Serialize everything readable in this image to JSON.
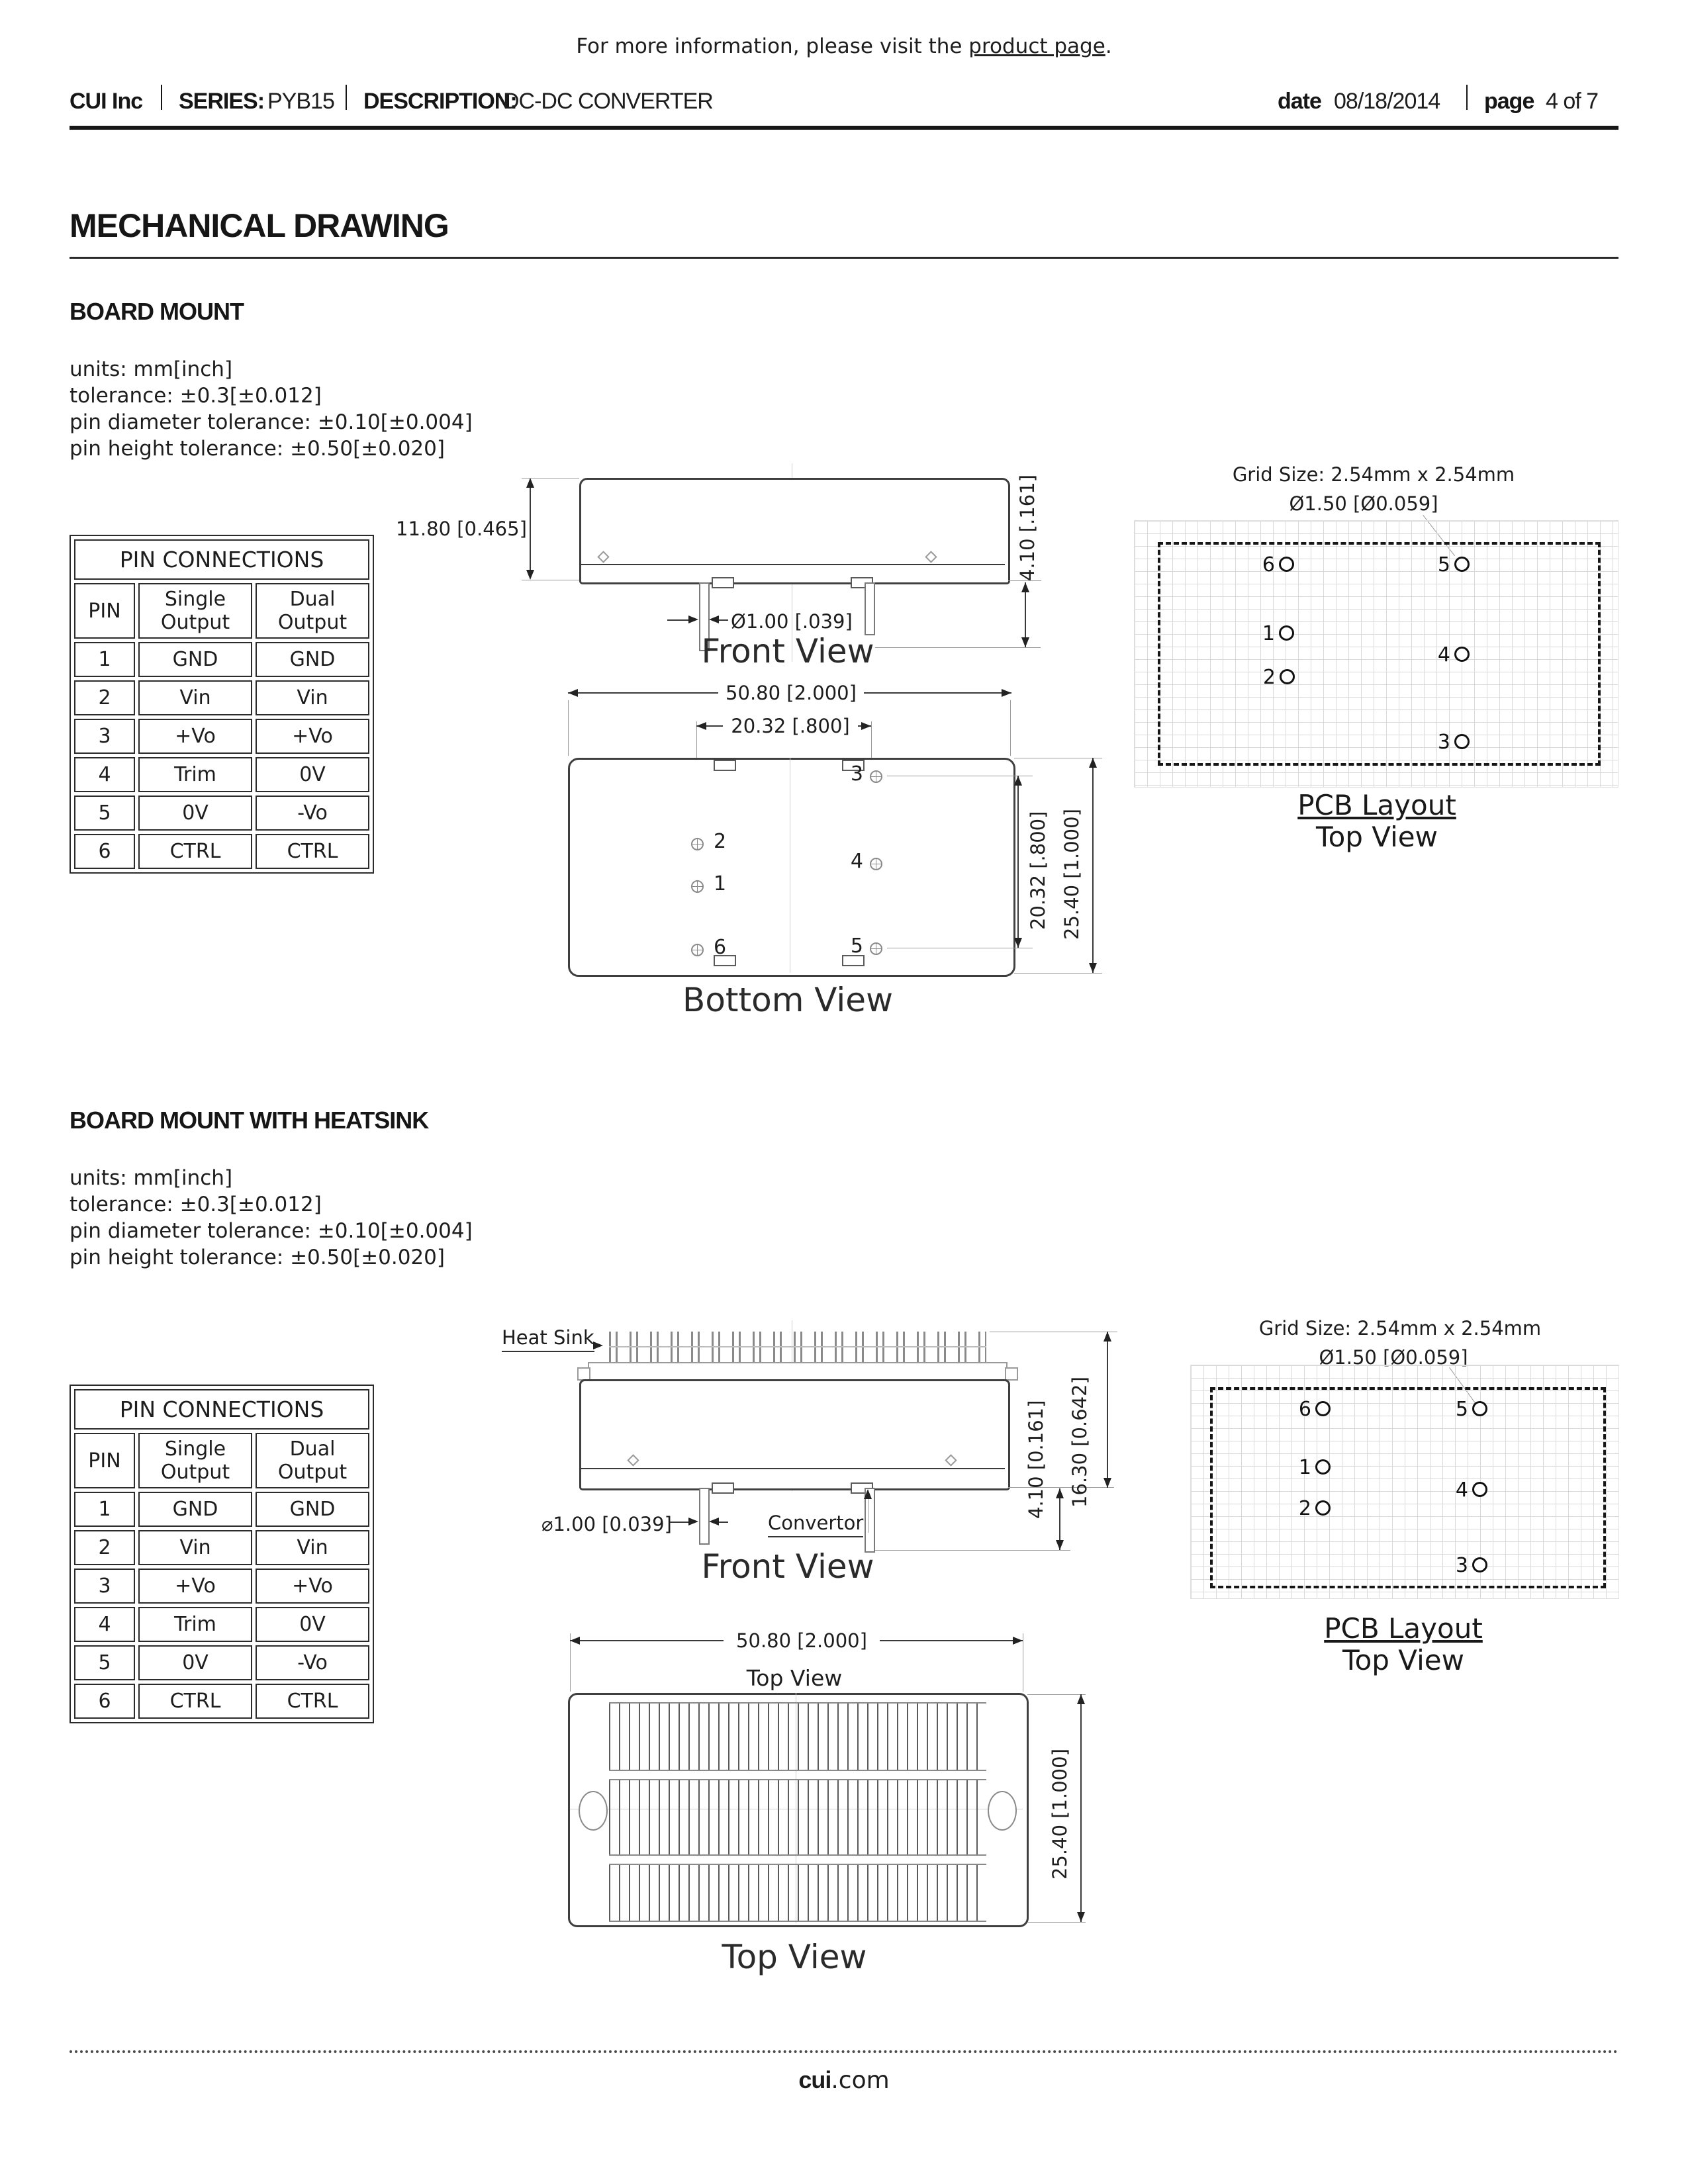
{
  "header": {
    "info_prefix": "For more information, please visit the ",
    "info_link": "product page",
    "info_suffix": ".",
    "company": "CUI Inc",
    "series_label": "SERIES:",
    "series_value": "PYB15",
    "description_label": "DESCRIPTION:",
    "description_value": "DC-DC CONVERTER",
    "date_label": "date",
    "date_value": "08/18/2014",
    "page_label": "page",
    "page_value": "4 of 7"
  },
  "page_title": "MECHANICAL DRAWING",
  "board_mount": {
    "heading": "BOARD MOUNT",
    "notes": [
      "units: mm[inch]",
      "tolerance: ±0.3[±0.012]",
      "pin diameter tolerance: ±0.10[±0.004]",
      "pin height tolerance: ±0.50[±0.020]"
    ],
    "pin_table": {
      "title": "PIN CONNECTIONS",
      "columns": [
        "PIN",
        "Single Output",
        "Dual Output"
      ],
      "rows": [
        [
          "1",
          "GND",
          "GND"
        ],
        [
          "2",
          "Vin",
          "Vin"
        ],
        [
          "3",
          "+Vo",
          "+Vo"
        ],
        [
          "4",
          "Trim",
          "0V"
        ],
        [
          "5",
          "0V",
          "-Vo"
        ],
        [
          "6",
          "CTRL",
          "CTRL"
        ]
      ]
    },
    "front_view": {
      "caption": "Front View",
      "dim_height": "11.80 [0.465]",
      "dim_pin_length": "4.10 [.161]",
      "dim_pin_diameter": "Ø1.00 [.039]"
    },
    "bottom_view": {
      "caption": "Bottom View",
      "dim_width": "50.80 [2.000]",
      "dim_pitch_horizontal": "20.32 [.800]",
      "dim_pitch_vertical": "20.32 [.800]",
      "dim_depth": "25.40 [1.000]",
      "pin_labels": [
        "1",
        "2",
        "3",
        "4",
        "5",
        "6"
      ]
    },
    "pcb_layout": {
      "grid_size_label": "Grid Size: 2.54mm x 2.54mm",
      "hole_label": "Ø1.50 [Ø0.059]",
      "caption": "PCB Layout",
      "subcaption": "Top View",
      "pin_labels": [
        "1",
        "2",
        "3",
        "4",
        "5",
        "6"
      ]
    }
  },
  "board_mount_heatsink": {
    "heading": "BOARD MOUNT WITH HEATSINK",
    "notes": [
      "units: mm[inch]",
      "tolerance: ±0.3[±0.012]",
      "pin diameter tolerance: ±0.10[±0.004]",
      "pin height tolerance: ±0.50[±0.020]"
    ],
    "pin_table": {
      "title": "PIN CONNECTIONS",
      "columns": [
        "PIN",
        "Single Output",
        "Dual Output"
      ],
      "rows": [
        [
          "1",
          "GND",
          "GND"
        ],
        [
          "2",
          "Vin",
          "Vin"
        ],
        [
          "3",
          "+Vo",
          "+Vo"
        ],
        [
          "4",
          "Trim",
          "0V"
        ],
        [
          "5",
          "0V",
          "-Vo"
        ],
        [
          "6",
          "CTRL",
          "CTRL"
        ]
      ]
    },
    "front_view": {
      "caption": "Front View",
      "heat_sink_label": "Heat Sink",
      "convertor_label": "Convertor",
      "dim_pin_diameter": "⌀1.00 [0.039]",
      "dim_pin_length": "4.10 [0.161]",
      "dim_total_height": "16.30 [0.642]"
    },
    "pcb_layout": {
      "grid_size_label": "Grid Size: 2.54mm x 2.54mm",
      "hole_label": "Ø1.50 [Ø0.059]",
      "caption": "PCB Layout",
      "subcaption": "Top View",
      "pin_labels": [
        "1",
        "2",
        "3",
        "4",
        "5",
        "6"
      ]
    },
    "top_view": {
      "caption": "Top View",
      "view_label": "Top View",
      "dim_width": "50.80 [2.000]",
      "dim_depth": "25.40 [1.000]"
    }
  },
  "footer": {
    "brand_bold": "cui",
    "brand_regular": ".com"
  },
  "colors": {
    "ink": "#1a1a1a",
    "drawing_line": "#3f3f3f",
    "hairline": "#9a9a9a",
    "grid_line": "#d9d9d9"
  }
}
